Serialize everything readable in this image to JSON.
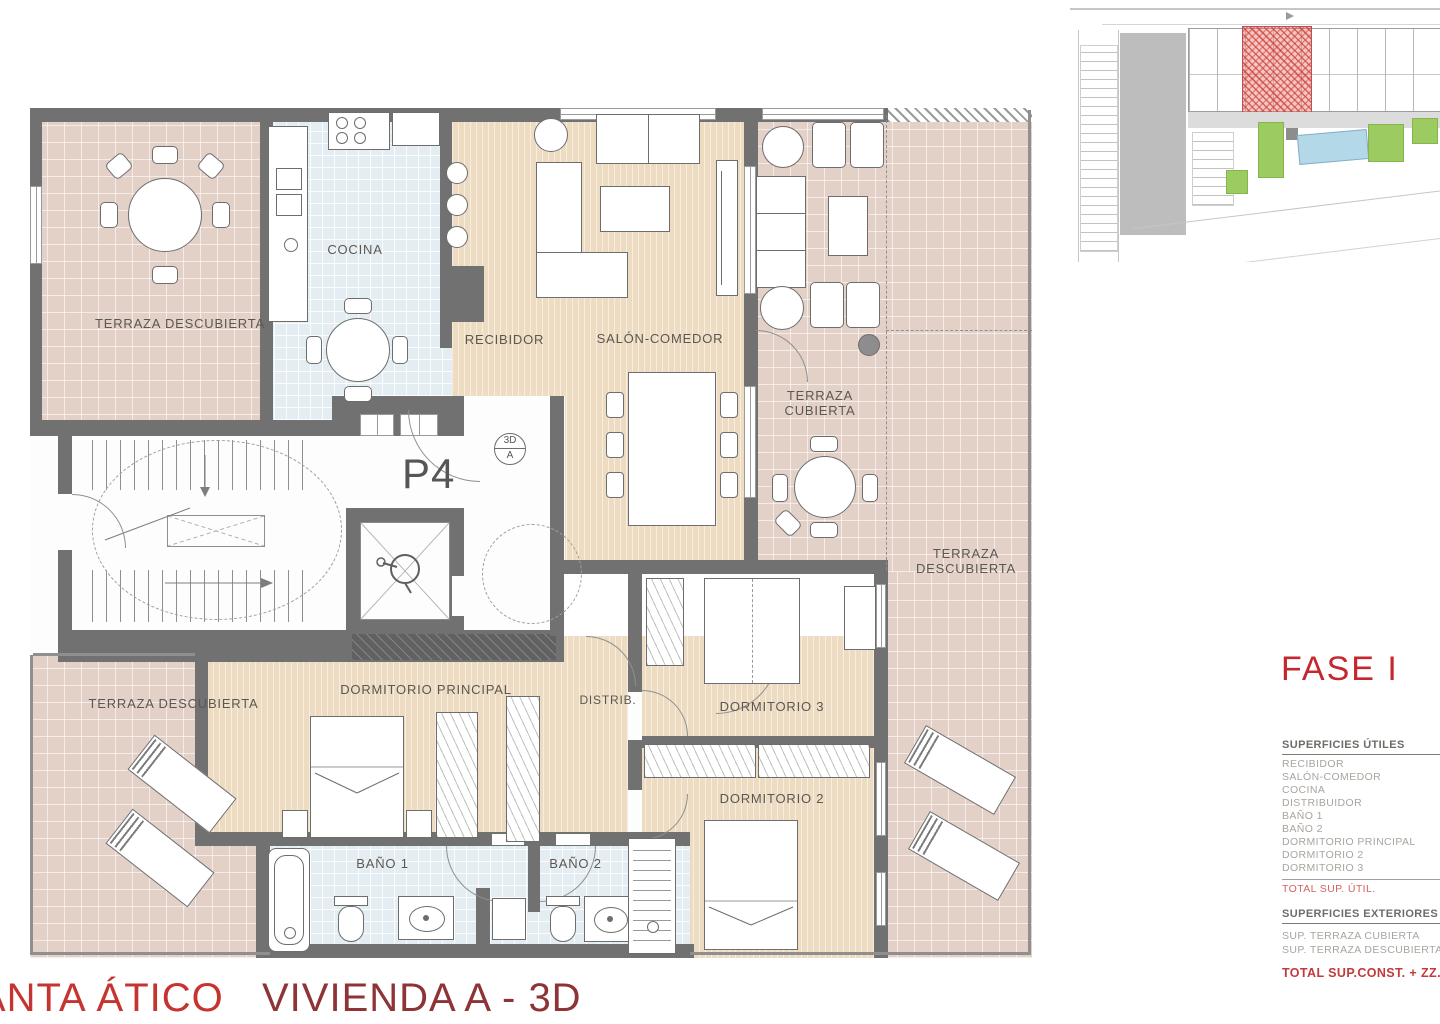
{
  "plan": {
    "rooms": {
      "terraza_top_left": "TERRAZA DESCUBIERTA",
      "cocina": "COCINA",
      "recibidor": "RECIBIDOR",
      "salon_comedor": "SALÓN-COMEDOR",
      "terraza_cubierta": "TERRAZA CUBIERTA",
      "terraza_right": "TERRAZA DESCUBIERTA",
      "dormitorio_principal": "DORMITORIO PRINCIPAL",
      "distribuidor": "DISTRIB.",
      "dormitorio_3": "DORMITORIO 3",
      "dormitorio_2": "DORMITORIO 2",
      "bano_1": "BAÑO 1",
      "bano_2": "BAÑO 2",
      "terraza_bottom_left": "TERRAZA DESCUBIERTA"
    },
    "unit_label": "P4",
    "view_marker": {
      "top": "3D",
      "bottom": "A"
    }
  },
  "side_panel": {
    "phase_label": "FASE I",
    "superficies_utiles": {
      "header": "SUPERFICIES ÚTILES",
      "items": [
        "RECIBIDOR",
        "SALÓN-COMEDOR",
        "COCINA",
        "DISTRIBUIDOR",
        "BAÑO 1",
        "BAÑO 2",
        "DORMITORIO PRINCIPAL",
        "DORMITORIO 2",
        "DORMITORIO 3"
      ],
      "total_label": "TOTAL SUP. ÚTIL."
    },
    "superficies_exteriores": {
      "header": "SUPERFICIES EXTERIORES",
      "items": [
        "SUP. TERRAZA CUBIERTA",
        "SUP. TERRAZA DESCUBIERTA"
      ],
      "total_label": "TOTAL SUP.CONST. + ZZ.CC."
    }
  },
  "footer": {
    "floor_label": "PLANTA ÁTICO",
    "unit_label": "VIVIENDA A - 3D"
  },
  "colors": {
    "terrace_tile": "#e3d0c7",
    "interior_wood": "#eddcc2",
    "wet_room_tile": "#e3edf2",
    "wall": "#717171",
    "accent_red": "#c4282e",
    "highlight_unit": "#d95f5a"
  }
}
